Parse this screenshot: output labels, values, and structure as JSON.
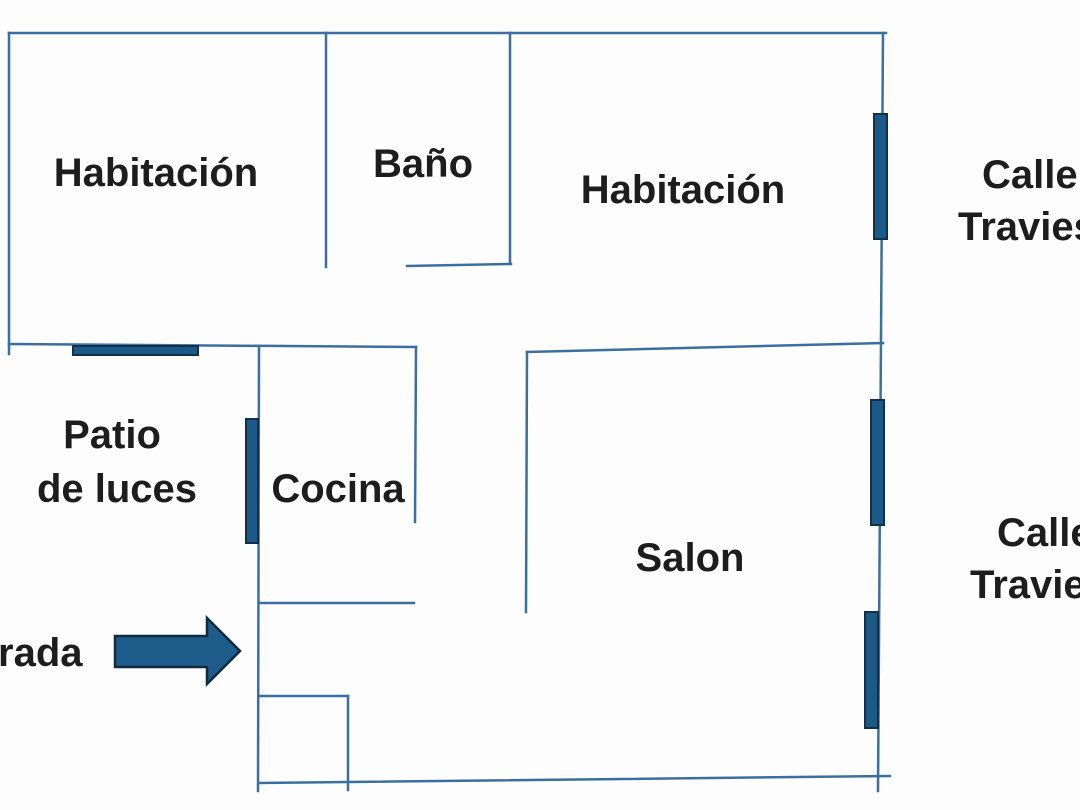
{
  "plan": {
    "background": "#fdfdfd",
    "colors": {
      "wall": "#3c6f9e",
      "window_fill": "#1b5a86",
      "window_border": "#132f49",
      "arrow_fill": "#1e5c8c",
      "arrow_border": "#102a3e",
      "label_text": "#1d1d1d"
    },
    "rooms": {
      "bedroom_left": "Habitación",
      "bathroom": "Baño",
      "bedroom_right": "Habitación",
      "patio_line1": "Patio",
      "patio_line2": "de luces",
      "kitchen": "Cocina",
      "living_room": "Salon"
    },
    "annotations": {
      "entrance_partial": "rada",
      "street_top_line1": "Calle",
      "street_top_line2": "Travies",
      "street_bottom_line1": "Calle",
      "street_bottom_line2": "Travie"
    }
  }
}
